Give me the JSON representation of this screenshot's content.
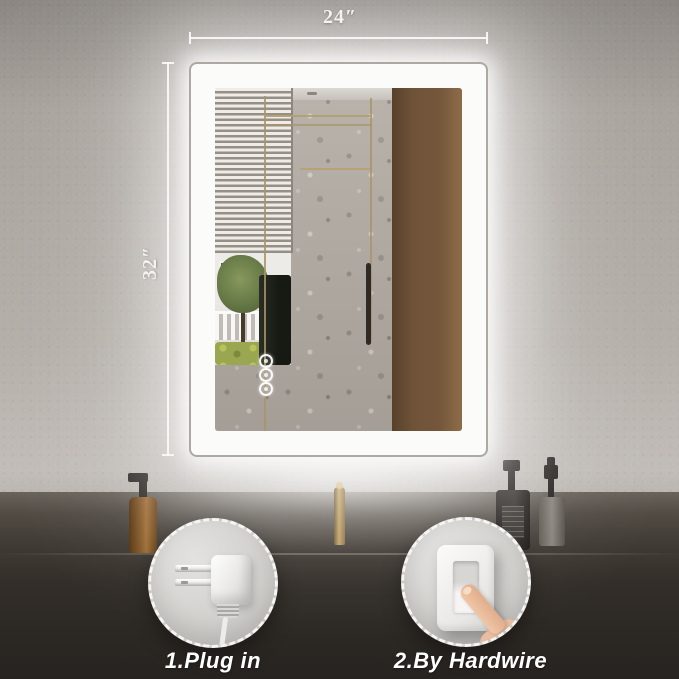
{
  "annotations": {
    "width": "24″",
    "height": "32″"
  },
  "callouts": [
    {
      "id": "plug",
      "label": "1.Plug in",
      "icon": "power-plug-icon"
    },
    {
      "id": "hardwire",
      "label": "2.By Hardwire",
      "icon": "light-switch-icon"
    }
  ],
  "mirror": {
    "touch_buttons": 3,
    "led_color": "#ffffff"
  },
  "colors": {
    "wall": "#b0aaa4",
    "wood_panel": "#6f5339",
    "terrazzo": "#b1aaa2",
    "counter": "#332e29",
    "badge_background": "#cfcecb",
    "gold_accent": "#a89467",
    "annotation_text": "#f4f3f1",
    "label_text": "#ffffff"
  }
}
